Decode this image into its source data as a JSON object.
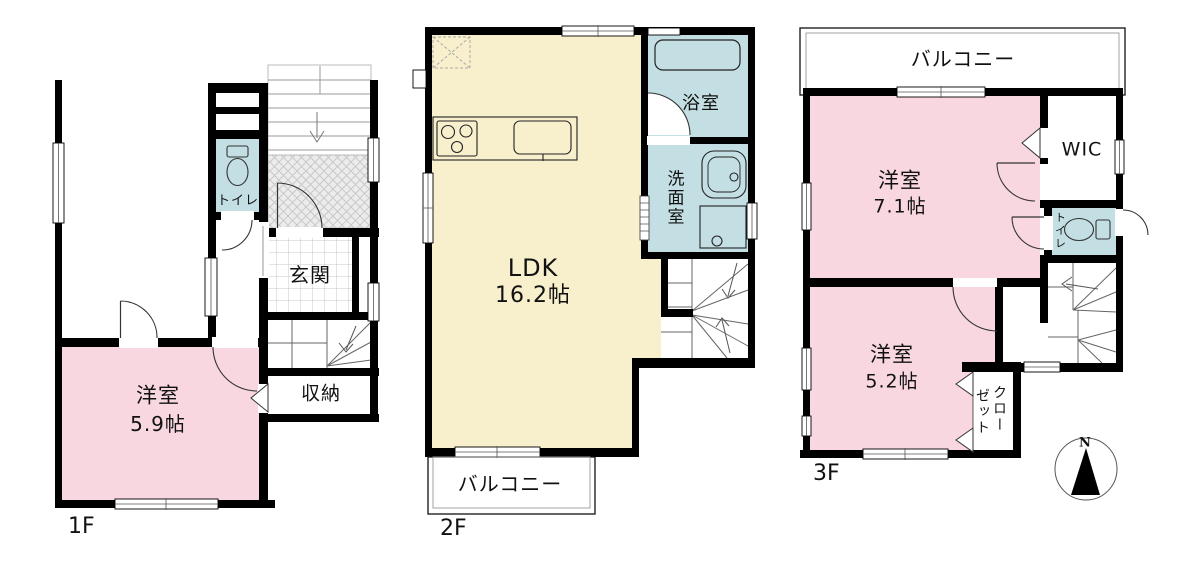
{
  "floors": {
    "f1": {
      "label": "1F",
      "room_name": "洋室",
      "room_size": "5.9帖",
      "toilet": "トイレ",
      "genkan": "玄関",
      "storage": "収納"
    },
    "f2": {
      "label": "2F",
      "ldk_name": "LDK",
      "ldk_size": "16.2帖",
      "bath": "浴室",
      "washroom": "洗面室",
      "balcony": "バルコニー"
    },
    "f3": {
      "label": "3F",
      "room1_name": "洋室",
      "room1_size": "7.1帖",
      "room2_name": "洋室",
      "room2_size": "5.2帖",
      "wic": "WIC",
      "toilet": "トイレ",
      "closet_line1": "クロー",
      "closet_line2": "ゼット",
      "balcony": "バルコニー"
    }
  },
  "compass": {
    "north": "N"
  },
  "colors": {
    "room_pink": "#f8d7e1",
    "water_blue": "#c3dfe3",
    "ldk_cream": "#f8efcc",
    "wall": "#000000"
  }
}
